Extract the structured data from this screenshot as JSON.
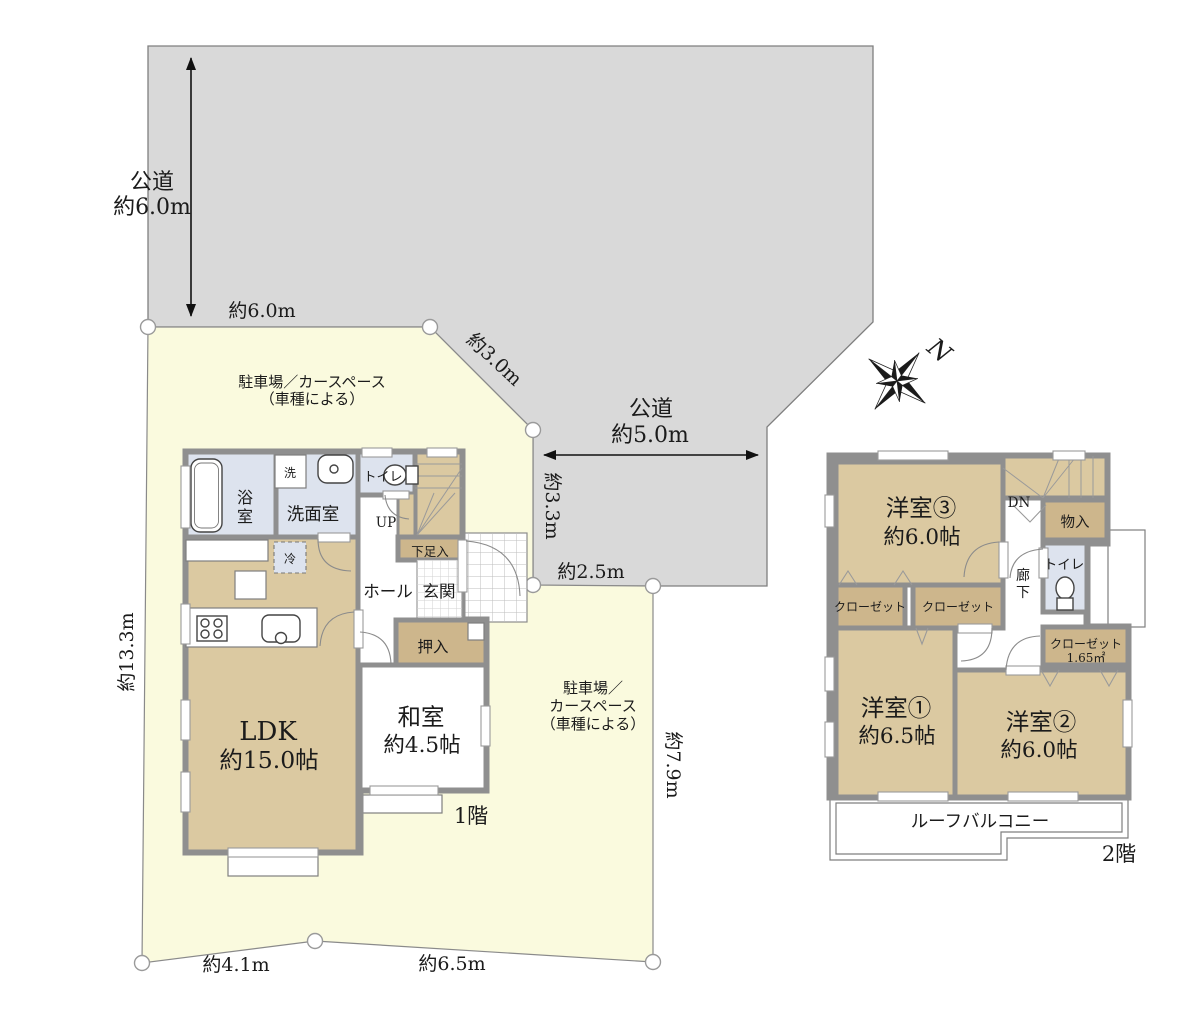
{
  "colors": {
    "road_fill": "#d9d9d9",
    "site_fill": "#fafade",
    "room_tan": "#dbc9a1",
    "closet_tan": "#cdb68c",
    "wet_blue": "#dde3ee",
    "wall_gray": "#8f8f8f",
    "text": "#1b1b1b"
  },
  "roads": {
    "top": {
      "name": "公道",
      "width": "約6.0m"
    },
    "side": {
      "name": "公道",
      "width": "約5.0m"
    }
  },
  "site": {
    "frontage_top": "約6.0m",
    "edge_diagonal": "約3.0m",
    "edge_east_upper": "約3.3m",
    "edge_east_mid": "約2.5m",
    "edge_east_lower": "約7.9m",
    "edge_west": "約13.3m",
    "edge_south_left": "約4.1m",
    "edge_south_right": "約6.5m",
    "parking_north": {
      "line1": "駐車場／カースペース",
      "line2": "（車種による）"
    },
    "parking_east": {
      "line1": "駐車場／",
      "line2": "カースペース",
      "line3": "（車種による）"
    },
    "compass": "N"
  },
  "floor1": {
    "label": "1階",
    "ldk": {
      "name": "LDK",
      "size": "約15.0帖"
    },
    "washitsu": {
      "name": "和室",
      "size": "約4.5帖"
    },
    "bath_c1": "浴",
    "bath_c2": "室",
    "washer": "洗",
    "senmenshitsu": "洗面室",
    "toilet": "トイレ",
    "up": "UP",
    "getabako": "下足入",
    "hall": "ホール",
    "genkan": "玄関",
    "oshiire": "押入",
    "fridge": "冷"
  },
  "floor2": {
    "label": "2階",
    "yoshitsu3": {
      "name": "洋室③",
      "size": "約6.0帖"
    },
    "yoshitsu1": {
      "name": "洋室①",
      "size": "約6.5帖"
    },
    "yoshitsu2": {
      "name": "洋室②",
      "size": "約6.0帖"
    },
    "dn": "DN",
    "monoire": "物入",
    "toilet": "トイレ",
    "corridor_c1": "廊",
    "corridor_c2": "下",
    "closet_a": "クローゼット",
    "closet_b": "クローゼット",
    "closet_c": {
      "name": "クローゼット",
      "size": "1.65㎡"
    },
    "roof_balcony": "ルーフバルコニー"
  }
}
